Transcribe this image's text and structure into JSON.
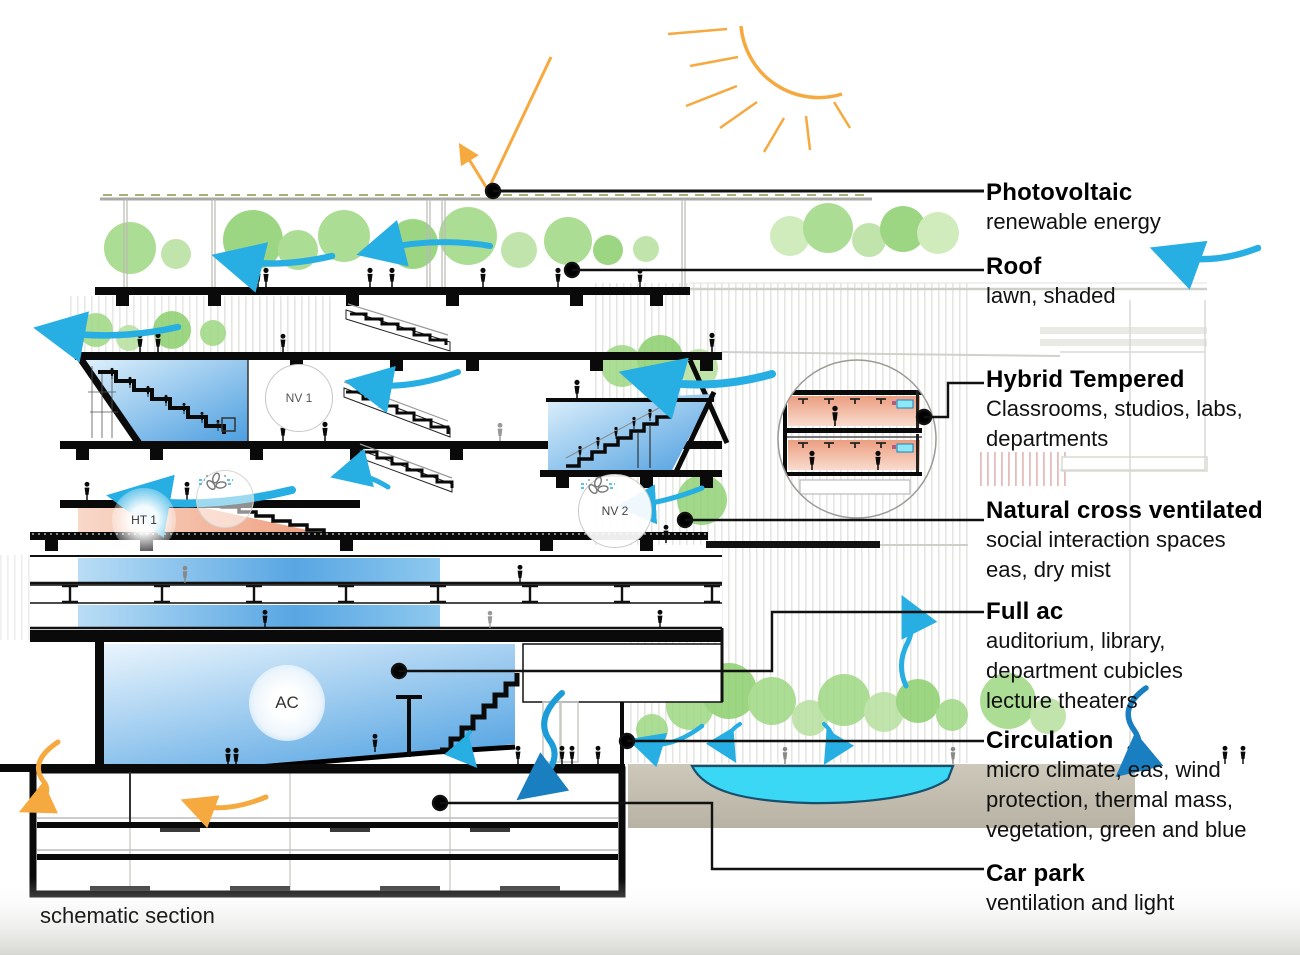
{
  "page": {
    "caption": "schematic section"
  },
  "zones": {
    "nv1": "NV 1",
    "nv2": "NV 2",
    "ht1": "HT 1",
    "ac": "AC"
  },
  "legend": {
    "items": [
      {
        "title": "Photovoltaic",
        "lines": [
          "renewable energy"
        ]
      },
      {
        "title": "Roof",
        "lines": [
          "lawn, shaded"
        ]
      },
      {
        "title": "Hybrid Tempered",
        "lines": [
          "Classrooms, studios, labs,",
          "departments"
        ]
      },
      {
        "title": "Natural cross ventilated",
        "lines": [
          "social interaction spaces",
          "eas, dry mist"
        ]
      },
      {
        "title": "Full ac",
        "lines": [
          "auditorium, library,",
          "department cubicles",
          "lecture theaters"
        ]
      },
      {
        "title": "Circulation",
        "lines": [
          "micro climate, eas, wind",
          "protection, thermal mass,",
          "vegetation, green and blue"
        ]
      },
      {
        "title": "Car park",
        "lines": [
          "ventilation and light"
        ]
      }
    ]
  },
  "colors": {
    "wind_cyan": "#27aee3",
    "wind_blue": "#1a7fc0",
    "sun_orange": "#f5a93f",
    "water_cyan": "#3bd8f5",
    "tree_green": "#9ed781",
    "room_blue": "#58a5e2",
    "room_warm": "#ee9a78",
    "line_black": "#111111"
  }
}
